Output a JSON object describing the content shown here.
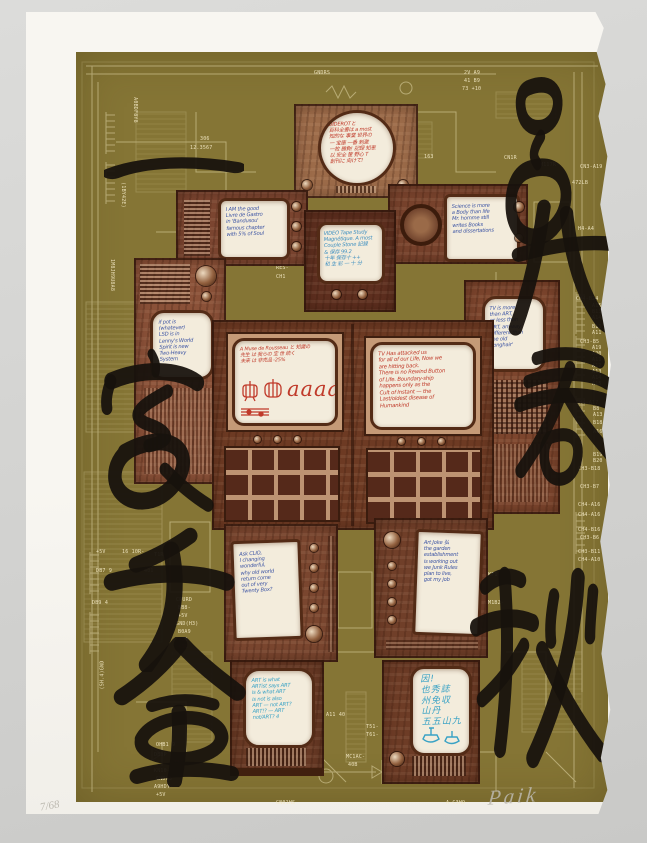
{
  "artwork": {
    "edition_text": "7/68",
    "signature_text": "Paik"
  },
  "calligraphy": {
    "left_phrase": "一家千金",
    "right_phrase": "呂氏春秋",
    "left_chars": [
      "一",
      "家",
      "千",
      "金"
    ],
    "right_chars": [
      "呂",
      "氏",
      "春",
      "秋"
    ]
  },
  "screen_notes": {
    "head": "DIDEROTと\n百科全書は a most\n知的な 事業 世界の\n一 宝庫 一番 刺激\n一枚 勝負! 記録 知恵\n以 安全 筐 野心 T\n創刊に 向けて!",
    "left_shoulder": "I AM the good\nLivre de Gastro\nin 'Bandusou'\nfamous chapter\nwith 5% of Soul",
    "right_shoulder": "Science is more\na Body than life\nMr. homme still\nwrites Books\nand dissertations",
    "chest": "VIDEO Tape Study\nMagnétique. A most\nCouple Stone 記録\n& 保存 99.2\n十年 保存十 ++\n和 生 彩 一 十 分",
    "left_arm": "if pot is\n(whatever)\nLSD is in\nLenny's World\nSpirit is new\nTwo-Heavy\nSystem",
    "right_arm": "TV is more\nthan ART,\nor less than\nART, anyway\ndifferent than\nthe old\n'longhair'",
    "torso_left_heading": "A Muse de Rousseau と 知識の\n先生 は 我らの 宝 世 続く\n未来 は 非売品 -25%",
    "torso_left_letters": "aaaa",
    "torso_right": "TV Has attacked us\nfor all of our Life, Now we\nare hitting back.\nThere is no Rewind Button\nof Life. Boundary-ship\nhappens only as the\nCult of Instant — the\nLast/oldest disease of\nHumankind",
    "left_leg": "Ask CLIO,\nI changing\nwonderful,\nwhy old world\nreturn come\nout of very\nTwenty Box?",
    "right_leg": "Art Joke 弘\nthe garden\nestablishment\nis working out\nwe Junk Rules\nplan to live,\ngot my job",
    "left_foot": "ART is what\nARTist says ART\nis & what ART\nis not is also\nART — not ART?\nART!? — ART\nnot/ART? 4",
    "right_foot": "因!\n也秀誌\n州免収\n山丹\n五五山九"
  },
  "colors": {
    "olive_background": "#857535",
    "schematic_line": "#ece2b4",
    "calligraphy_ink": "#17120d",
    "wood_brown": "#7c4830",
    "screen_cream": "#f3ecdc",
    "ink_red": "#c03a2a",
    "ink_blue": "#3d55a4",
    "ink_cyan": "#39a2c5"
  },
  "schematic_labels": [
    {
      "t": "GNDRS",
      "x": 238,
      "y": 18
    },
    {
      "t": "306",
      "x": 124,
      "y": 84
    },
    {
      "t": "12.3567",
      "x": 114,
      "y": 93
    },
    {
      "t": "2V  A9",
      "x": 388,
      "y": 18
    },
    {
      "t": "41  B9",
      "x": 388,
      "y": 26
    },
    {
      "t": "73  +10",
      "x": 386,
      "y": 34
    },
    {
      "t": "163",
      "x": 348,
      "y": 102
    },
    {
      "t": "CN1R",
      "x": 428,
      "y": 103
    },
    {
      "t": "M117R-",
      "x": 464,
      "y": 110
    },
    {
      "t": "CN3-A19",
      "x": 504,
      "y": 112
    },
    {
      "t": "472LB",
      "x": 496,
      "y": 128
    },
    {
      "t": "H4-A4",
      "x": 502,
      "y": 174
    },
    {
      "t": "RES-",
      "x": 200,
      "y": 213
    },
    {
      "t": "CH1",
      "x": 200,
      "y": 222
    },
    {
      "t": "CH4-B24",
      "x": 500,
      "y": 244
    },
    {
      "t": "A15",
      "x": 516,
      "y": 251
    },
    {
      "t": "B13",
      "x": 516,
      "y": 257
    },
    {
      "t": "A14",
      "x": 516,
      "y": 263
    },
    {
      "t": "B11",
      "x": 516,
      "y": 272
    },
    {
      "t": "A11",
      "x": 516,
      "y": 278
    },
    {
      "t": "CH3-B5",
      "x": 504,
      "y": 287
    },
    {
      "t": "A19",
      "x": 516,
      "y": 293
    },
    {
      "t": "A20",
      "x": 516,
      "y": 299
    },
    {
      "t": "A11",
      "x": 516,
      "y": 305
    },
    {
      "t": "A12",
      "x": 516,
      "y": 311
    },
    {
      "t": "A13",
      "x": 516,
      "y": 317
    },
    {
      "t": "A14",
      "x": 516,
      "y": 323
    },
    {
      "t": "A15",
      "x": 516,
      "y": 329
    },
    {
      "t": "CH4-A17",
      "x": 500,
      "y": 348
    },
    {
      "t": "B8",
      "x": 517,
      "y": 354
    },
    {
      "t": "A13",
      "x": 517,
      "y": 360
    },
    {
      "t": "B18",
      "x": 517,
      "y": 368
    },
    {
      "t": "A16",
      "x": 517,
      "y": 377
    },
    {
      "t": "B19",
      "x": 517,
      "y": 400
    },
    {
      "t": "B20",
      "x": 517,
      "y": 406
    },
    {
      "t": "CH3-B18",
      "x": 502,
      "y": 414
    },
    {
      "t": "CH3-B7",
      "x": 504,
      "y": 432
    },
    {
      "t": "CH4-A16",
      "x": 502,
      "y": 450
    },
    {
      "t": "CH4-A16",
      "x": 502,
      "y": 460
    },
    {
      "t": "CH4-B16",
      "x": 502,
      "y": 475
    },
    {
      "t": "CH3-B6",
      "x": 504,
      "y": 483
    },
    {
      "t": "CH3-B11",
      "x": 502,
      "y": 497
    },
    {
      "t": "CH4-A10",
      "x": 502,
      "y": 505
    },
    {
      "t": "KF1-",
      "x": 412,
      "y": 520
    },
    {
      "t": "M1B2-",
      "x": 412,
      "y": 548
    },
    {
      "t": "304",
      "x": 68,
      "y": 336
    },
    {
      "t": "704B",
      "x": 108,
      "y": 330
    },
    {
      "t": "+5V",
      "x": 20,
      "y": 497
    },
    {
      "t": "16 10R-",
      "x": 46,
      "y": 497
    },
    {
      "t": "T1R-",
      "x": 78,
      "y": 500
    },
    {
      "t": "DB7 9",
      "x": 20,
      "y": 516
    },
    {
      "t": "401",
      "x": 68,
      "y": 516
    },
    {
      "t": "DB9 4",
      "x": 16,
      "y": 548
    },
    {
      "t": "CPURD",
      "x": 100,
      "y": 545
    },
    {
      "t": "BB8-",
      "x": 102,
      "y": 553
    },
    {
      "t": "+5V",
      "x": 102,
      "y": 561
    },
    {
      "t": "GND(H3)",
      "x": 100,
      "y": 569
    },
    {
      "t": "B0A9",
      "x": 102,
      "y": 577
    },
    {
      "t": "+1R",
      "x": 102,
      "y": 585
    },
    {
      "t": "+3R",
      "x": 102,
      "y": 592
    },
    {
      "t": "A11  40",
      "x": 250,
      "y": 660
    },
    {
      "t": "T51-",
      "x": 290,
      "y": 672
    },
    {
      "t": "T61-",
      "x": 290,
      "y": 680
    },
    {
      "t": "MC1AC-",
      "x": 270,
      "y": 702
    },
    {
      "t": "40B",
      "x": 272,
      "y": 710
    },
    {
      "t": "OHB1 9",
      "x": 80,
      "y": 690
    },
    {
      "t": "DB3P",
      "x": 78,
      "y": 700
    },
    {
      "t": "T51-",
      "x": 98,
      "y": 708
    },
    {
      "t": "KN10-",
      "x": 78,
      "y": 716
    },
    {
      "t": "GNDH3",
      "x": 80,
      "y": 724
    },
    {
      "t": "A9HDY-",
      "x": 78,
      "y": 732
    },
    {
      "t": "+5V",
      "x": 80,
      "y": 740
    },
    {
      "t": "A C4H",
      "x": 380,
      "y": 716
    },
    {
      "t": "GN01HS",
      "x": 200,
      "y": 748
    },
    {
      "t": "A-C3H9",
      "x": 370,
      "y": 748
    },
    {
      "t": "A0BDF8Y8",
      "x": 46,
      "y": 55,
      "r": 90
    },
    {
      "t": "(1BY42E)",
      "x": 34,
      "y": 140,
      "r": 90
    },
    {
      "t": "1M8JH9U8A8",
      "x": 20,
      "y": 220,
      "r": 90
    },
    {
      "t": "(SH.4)GND",
      "x": 12,
      "y": 620,
      "r": -90
    }
  ]
}
